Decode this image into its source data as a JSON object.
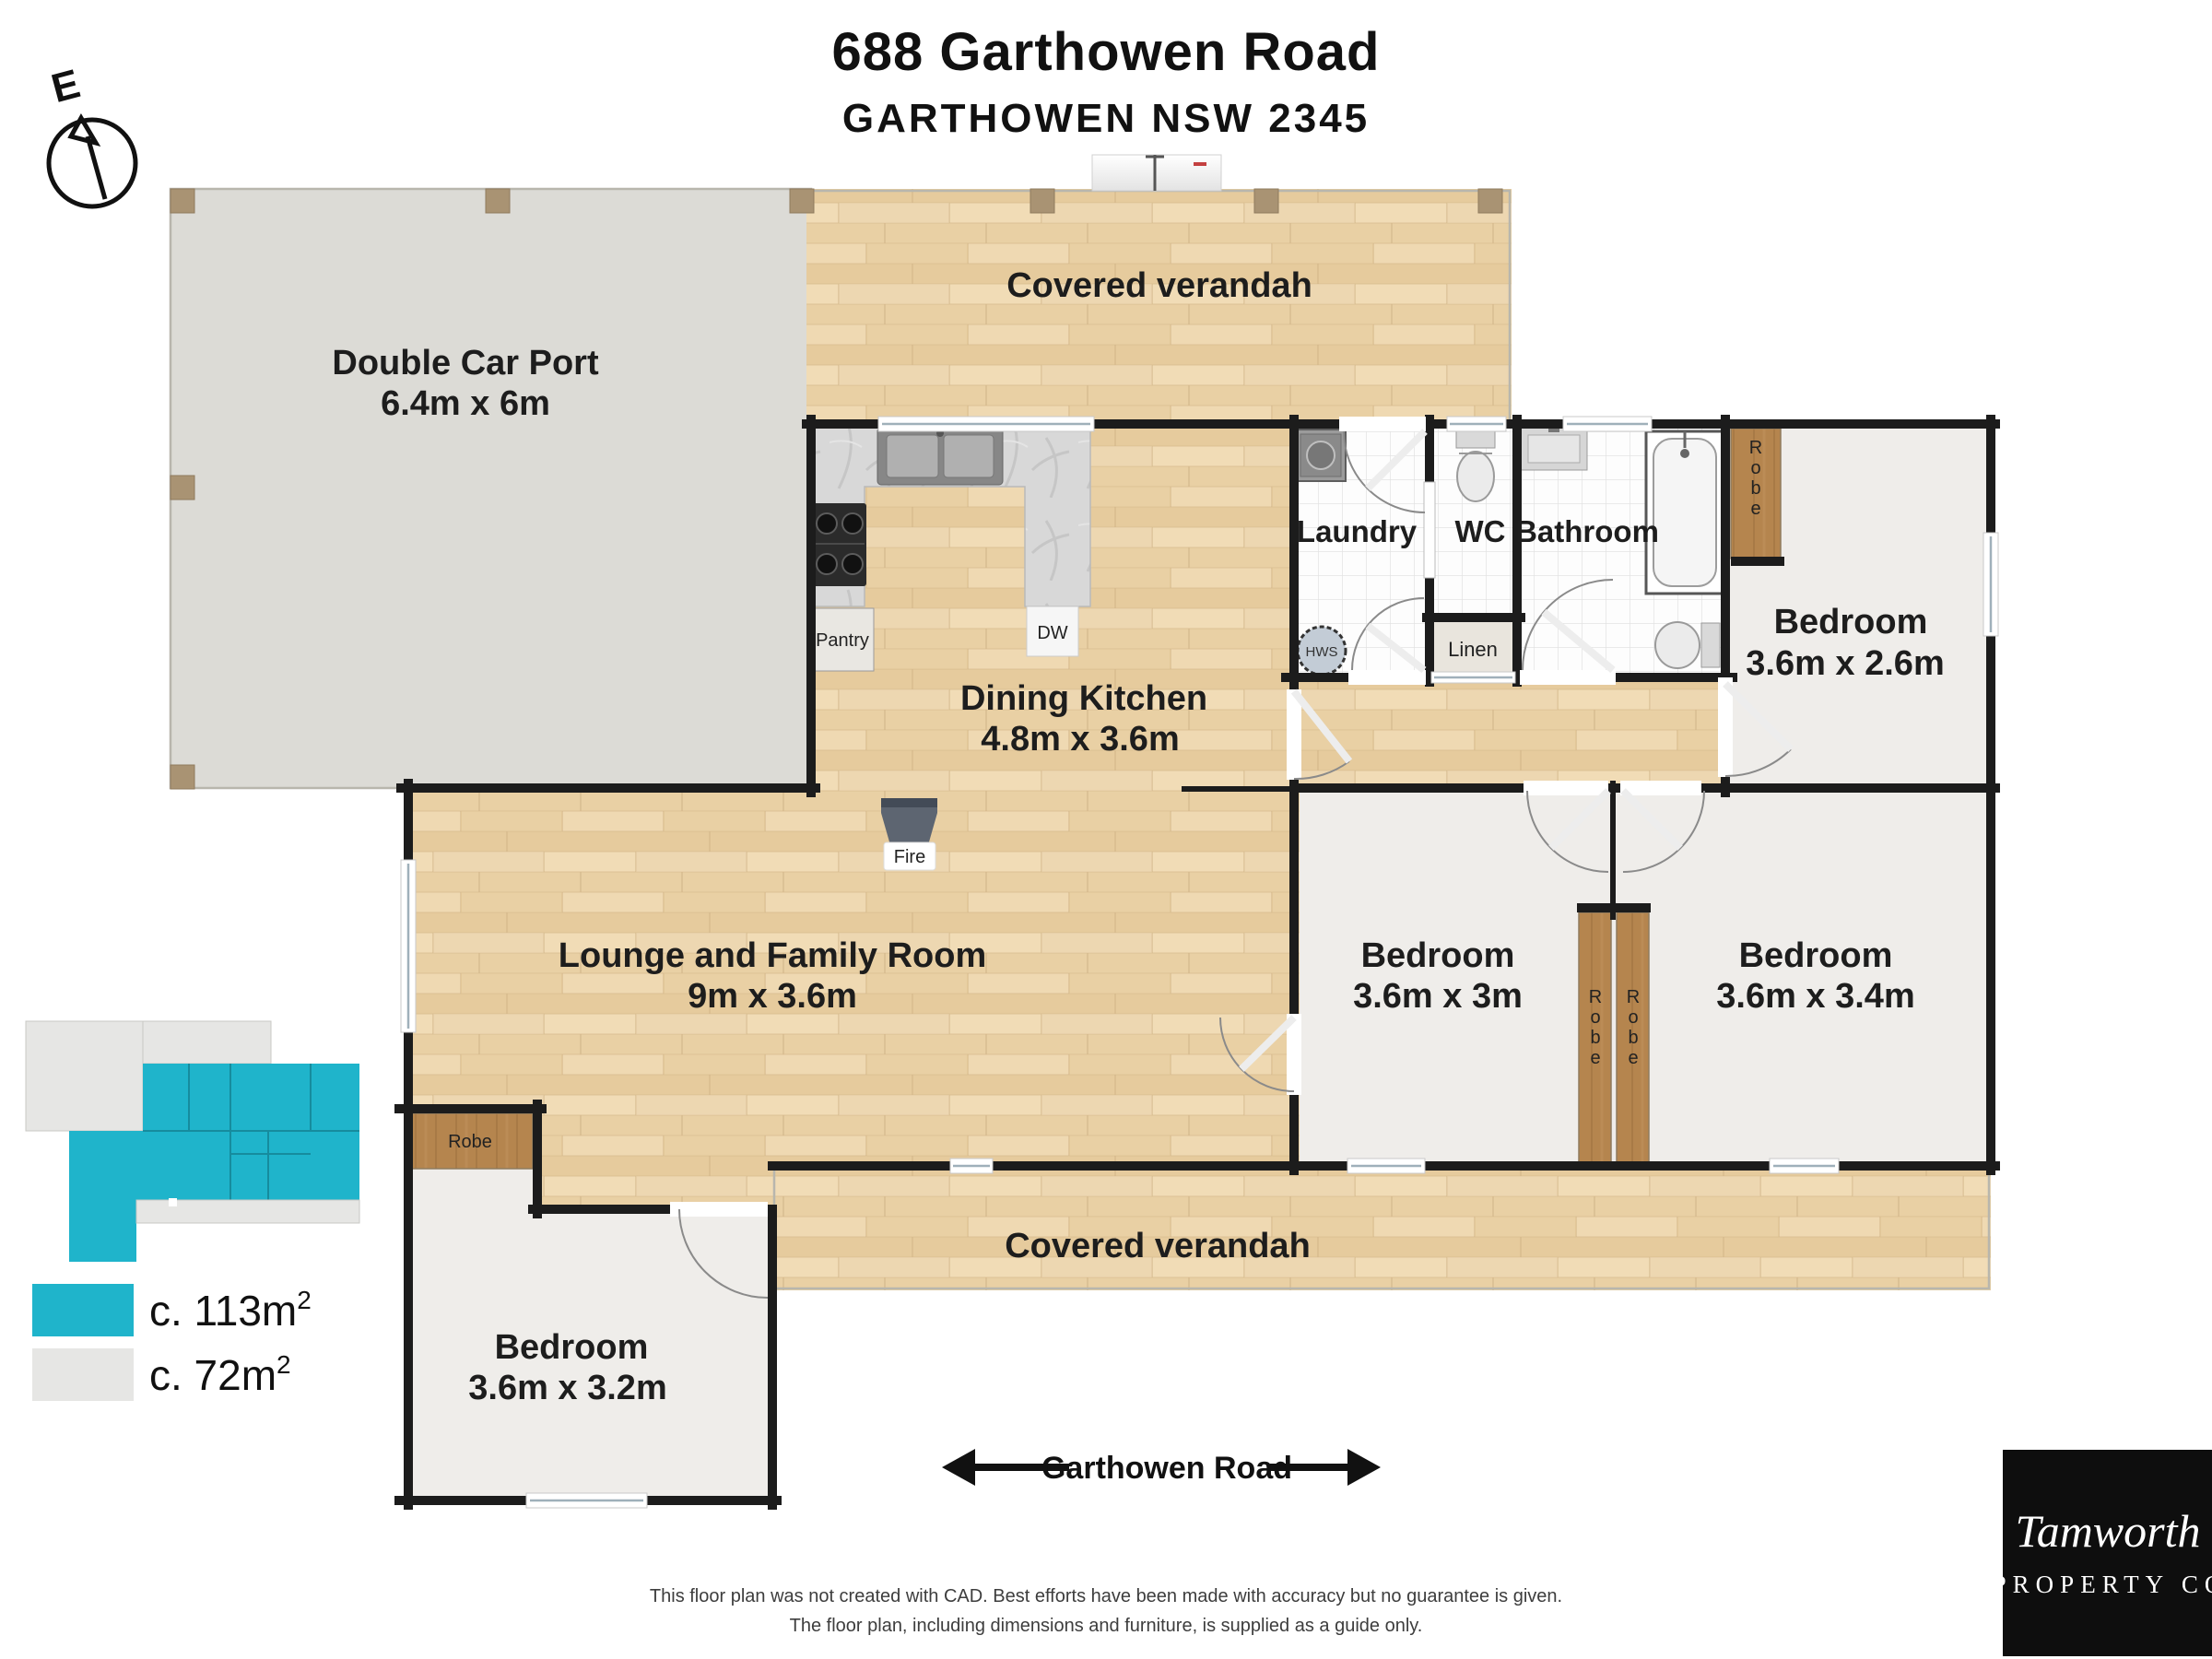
{
  "title": {
    "line1": "688 Garthowen Road",
    "line2": "GARTHOWEN NSW 2345"
  },
  "compass": {
    "label": "E"
  },
  "rooms": {
    "carport": {
      "name": "Double Car Port",
      "dims": "6.4m x 6m"
    },
    "verandah_top": {
      "name": "Covered verandah"
    },
    "verandah_bottom": {
      "name": "Covered verandah"
    },
    "dining_kitchen": {
      "name": "Dining Kitchen",
      "dims": "4.8m x 3.6m"
    },
    "lounge": {
      "name": "Lounge and Family Room",
      "dims": "9m x 3.6m"
    },
    "laundry": {
      "name": "Laundry"
    },
    "wc": {
      "name": "WC"
    },
    "bathroom": {
      "name": "Bathroom"
    },
    "linen": {
      "name": "Linen"
    },
    "bedroom_ne": {
      "name": "Bedroom",
      "dims": "3.6m x 2.6m"
    },
    "bedroom_s1": {
      "name": "Bedroom",
      "dims": "3.6m x 3m"
    },
    "bedroom_s2": {
      "name": "Bedroom",
      "dims": "3.6m x 3.4m"
    },
    "bedroom_sw": {
      "name": "Bedroom",
      "dims": "3.6m x 3.2m"
    }
  },
  "labels": {
    "pantry": "Pantry",
    "dw": "DW",
    "fire": "Fire",
    "hws": "HWS",
    "robe": "Robe"
  },
  "legend": [
    {
      "area": "c. 113m",
      "sup": "2"
    },
    {
      "area": "c. 72m",
      "sup": "2"
    }
  ],
  "road": {
    "name": "Garthowen Road"
  },
  "disclaimer": {
    "line1": "This floor plan was not created with CAD.  Best efforts have been made with accuracy but no guarantee is given.",
    "line2": "The floor plan, including dimensions and furniture, is supplied as a guide only."
  },
  "logo": {
    "script": "Tamworth",
    "caps": "PROPERTY CO"
  },
  "colors": {
    "accent": "#1fb4cb",
    "legend-gray": "#e6e6e4",
    "wall": "#1c1c1c",
    "floor-carpet": "#efedea",
    "floor-carport": "#dcdbd6",
    "robe-wood": "#b5854e"
  }
}
